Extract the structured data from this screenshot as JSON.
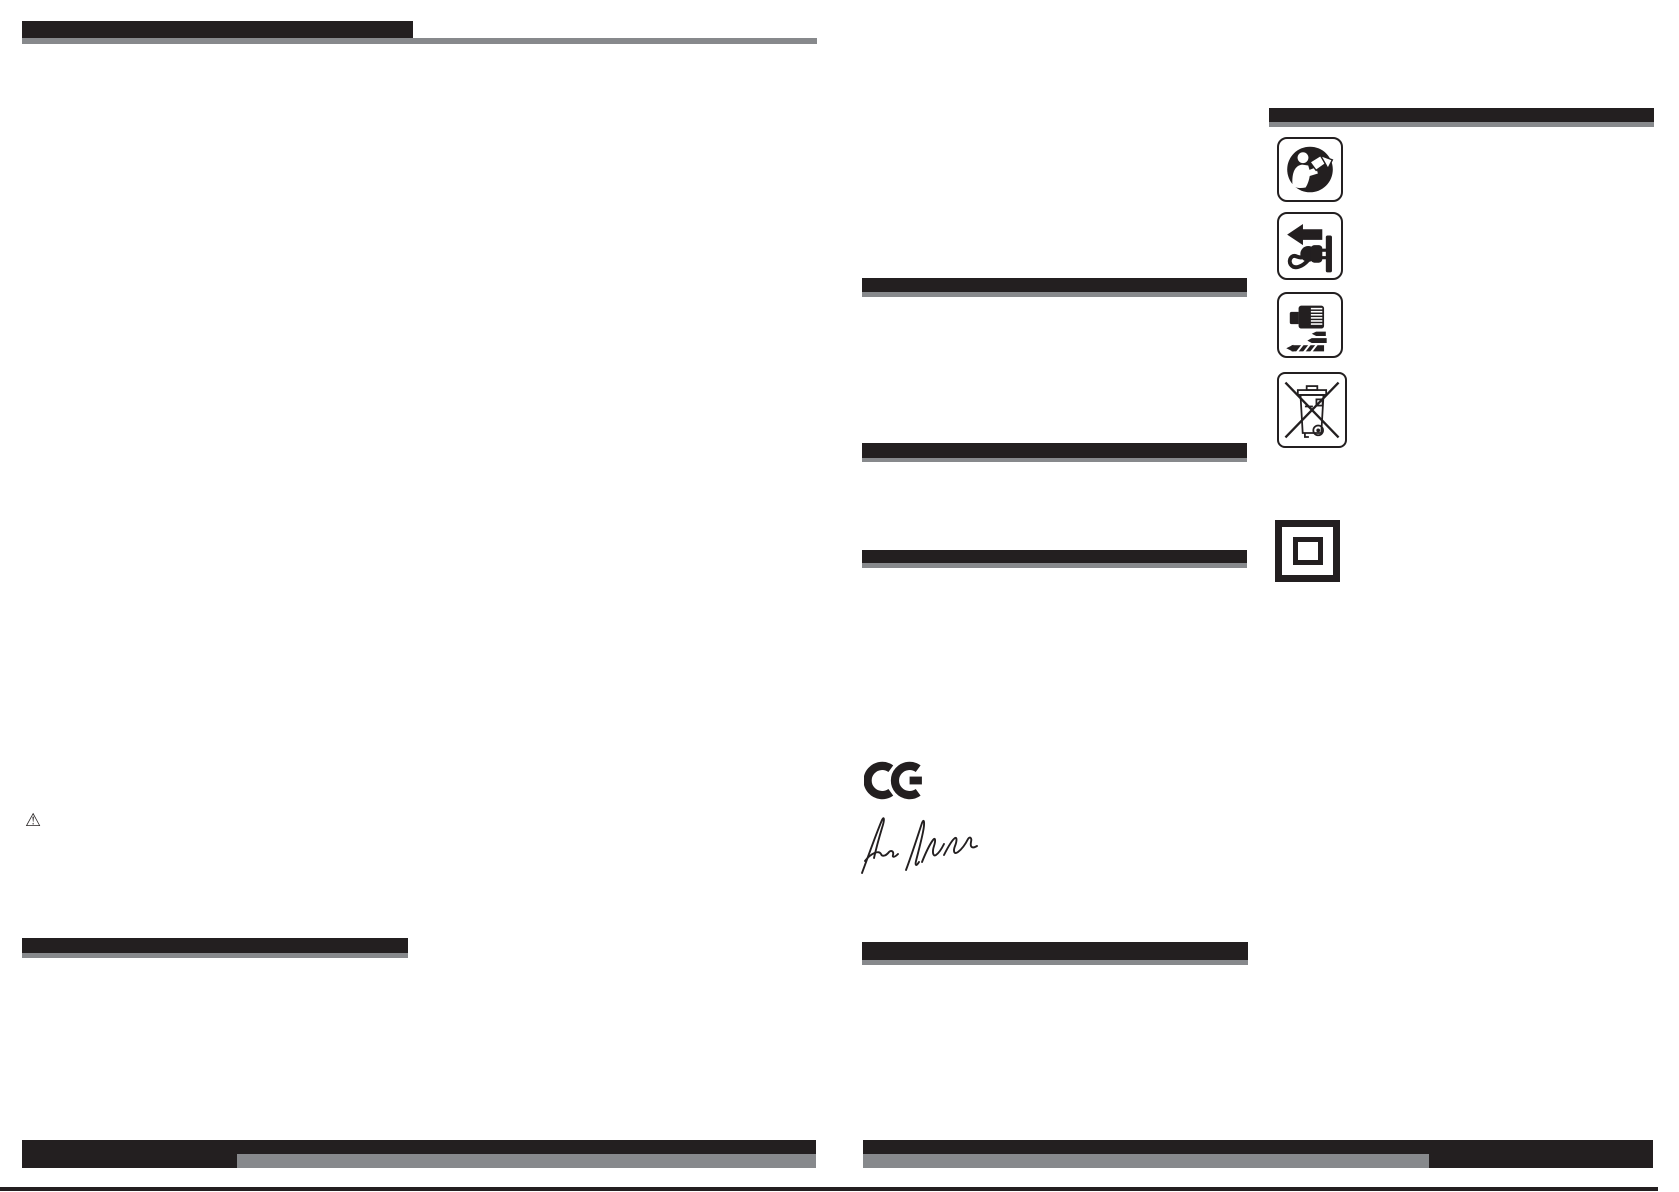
{
  "colors": {
    "ink": "#231f20",
    "gray": "#87898c",
    "paper": "#ffffff"
  },
  "left_page": {
    "warning_icon": {
      "id": "warning-triangle-icon",
      "glyph": "⚠"
    }
  },
  "right_page": {
    "safety_symbols": [
      {
        "id": "read-manual-icon"
      },
      {
        "id": "unplug-icon"
      },
      {
        "id": "drill-chuck-bits-icon"
      },
      {
        "id": "weee-no-trash-icon"
      }
    ],
    "insulation_symbol": {
      "id": "double-insulation-icon"
    },
    "ce_mark": {
      "label": "CE"
    },
    "signature": {
      "id": "handwritten-signature"
    }
  }
}
